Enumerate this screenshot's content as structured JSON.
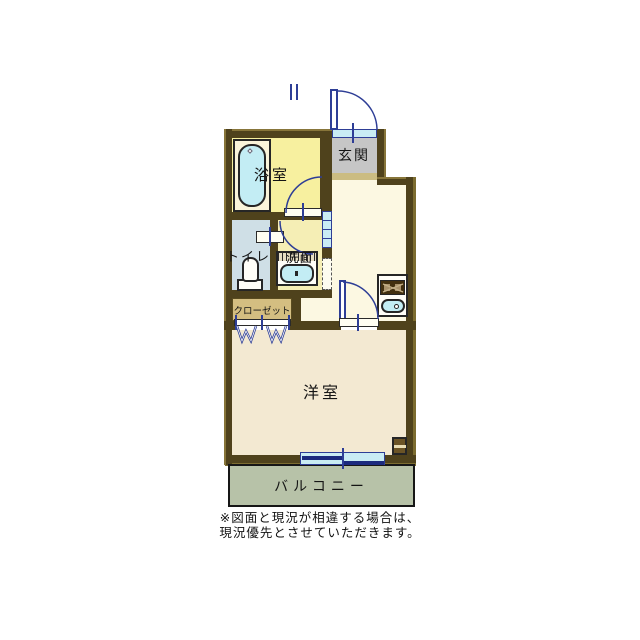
{
  "floorplan": {
    "labels": {
      "bathroom": "浴室",
      "entrance": "玄関",
      "toilet": "トイレ",
      "washroom": "洗面",
      "closet": "クローゼット",
      "western_room": "洋室",
      "balcony": "バルコニー"
    },
    "note": {
      "line1": "※図面と現況が相違する場合は、",
      "line2": "現況優先とさせていただきます。"
    },
    "icons": {
      "bathtub-icon": "rounded rect, light cyan",
      "toilet-icon": "bowl + tank shape, white",
      "washbasin-icon": "hatched counter + cyan bowl",
      "stove-icon": "dark strip with burners and X",
      "kitchen-sink-icon": "cyan rounded rect with drain circle",
      "hanger-icon": "blue W zigzag x2",
      "door-swing-icon": "quarter-circle blue arc",
      "sliding-window-icon": "offset navy double bars on cyan",
      "entrance-door-icon": "leaf + outward arc"
    },
    "colors": {
      "wall": "#4f421c",
      "wall_edge": "#7c6c30",
      "bathroom_floor": "#f7f09f",
      "entrance_floor": "#c6c6c6",
      "entrance_step": "#cbbc82",
      "hall_floor": "#fcf8e2",
      "toilet_floor": "#cfdfe6",
      "washroom_floor": "#f5eeb5",
      "closet_fill": "#d4be81",
      "room_floor": "#f3e9d2",
      "balcony_floor": "#b7c2a8",
      "water_fixture": "#c3edf4",
      "window_fill": "#c9ecf4",
      "door_line": "#2e3e96",
      "stove": "#42300f",
      "background": "#ffffff"
    }
  }
}
